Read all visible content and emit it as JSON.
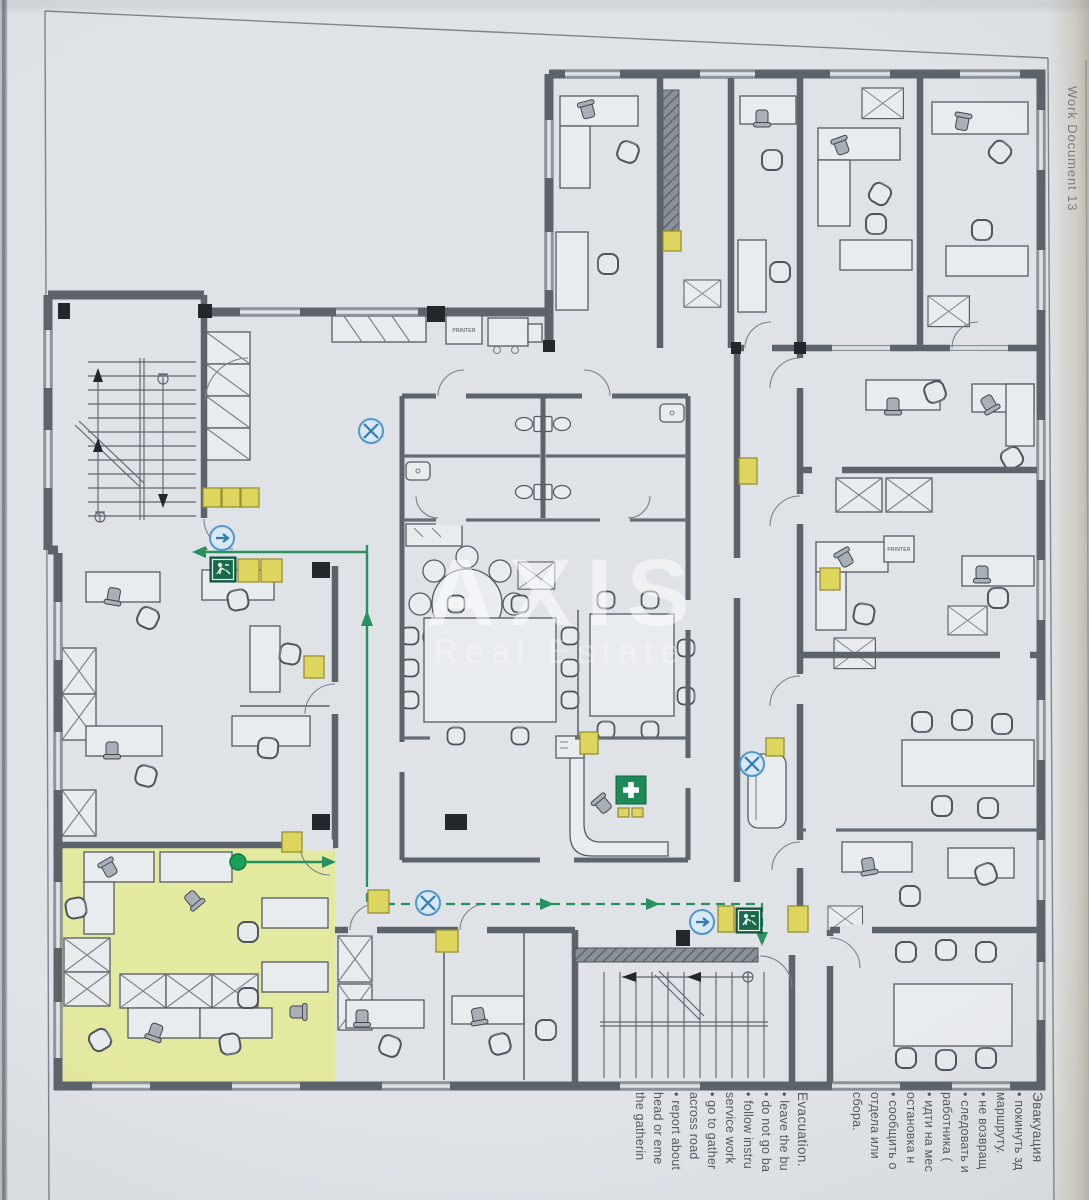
{
  "document": {
    "side_label": "Work Document 13",
    "watermark_title": "AXIS",
    "watermark_subtitle": "Real Estate"
  },
  "plan": {
    "printer_label": "PRINTER",
    "colors": {
      "paper": "#dfe3e7",
      "wall_gray": "#5c636b",
      "highlight_room": "#e4e9a0",
      "route_green": "#27925f",
      "exit_sign_green": "#17694a",
      "first_aid_green": "#1f8a58",
      "safety_sign_yellow": "#ddd55e",
      "direction_sign_blue": "#4f97cc"
    },
    "icons": {
      "exit": "exit-running-man-icon",
      "first_aid": "first-aid-cross-icon",
      "safety": "fire-safety-sign-icon",
      "direction": "direction-arrow-sign-icon",
      "no_exit": "crossed-circle-sign-icon",
      "start": "start-point-dot-icon"
    }
  },
  "legend": {
    "russian": {
      "title": "Эвакуация",
      "lines": [
        "• покинуть зд",
        "маршруту.",
        "• не возвращ",
        "• следовать и",
        "работника (",
        "• идти на мес",
        "остановка н",
        "• сообщить о",
        "отдела или",
        "сбора."
      ]
    },
    "english": {
      "title": "Evacuation.",
      "lines": [
        "• leave the bu",
        "• do not go ba",
        "• follow instru",
        "service work",
        "• go to gather",
        "across road",
        "• report about",
        "head or eme",
        "the gatherin"
      ]
    }
  }
}
